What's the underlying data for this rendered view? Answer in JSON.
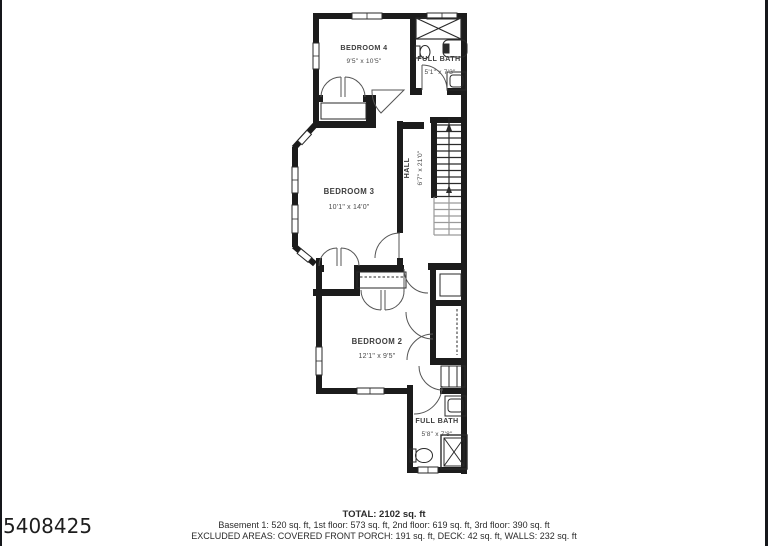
{
  "floorplan": {
    "rooms": [
      {
        "id": "bedroom4",
        "name": "BEDROOM 4",
        "dims": "9'5\" x 10'5\""
      },
      {
        "id": "full-bath-upper",
        "name": "FULL BATH",
        "dims": "5'1\" x 7'3\""
      },
      {
        "id": "bedroom3",
        "name": "BEDROOM 3",
        "dims": "10'1\" x 14'0\""
      },
      {
        "id": "hall",
        "name": "HALL",
        "dims": "6'7\" x 21'0\""
      },
      {
        "id": "bedroom2",
        "name": "BEDROOM 2",
        "dims": "12'1\" x 9'5\""
      },
      {
        "id": "full-bath-lower",
        "name": "FULL BATH",
        "dims": "5'8\" x 7'8\""
      }
    ],
    "colors": {
      "wall": "#1c1c1c",
      "thin_line": "#2a2a2a",
      "door_arc": "#555555",
      "stair_light": "#9a9a9a",
      "label_text": "#3d3d3d"
    }
  },
  "summary": {
    "total": "TOTAL: 2102 sq. ft",
    "floors": "Basement 1: 520 sq. ft, 1st floor: 573 sq. ft, 2nd floor: 619 sq. ft, 3rd floor: 390 sq. ft",
    "excluded": "EXCLUDED AREAS: COVERED FRONT PORCH: 191 sq. ft, DECK: 42 sq. ft, WALLS: 232 sq. ft"
  },
  "watermark": {
    "id_number": "5408425"
  }
}
